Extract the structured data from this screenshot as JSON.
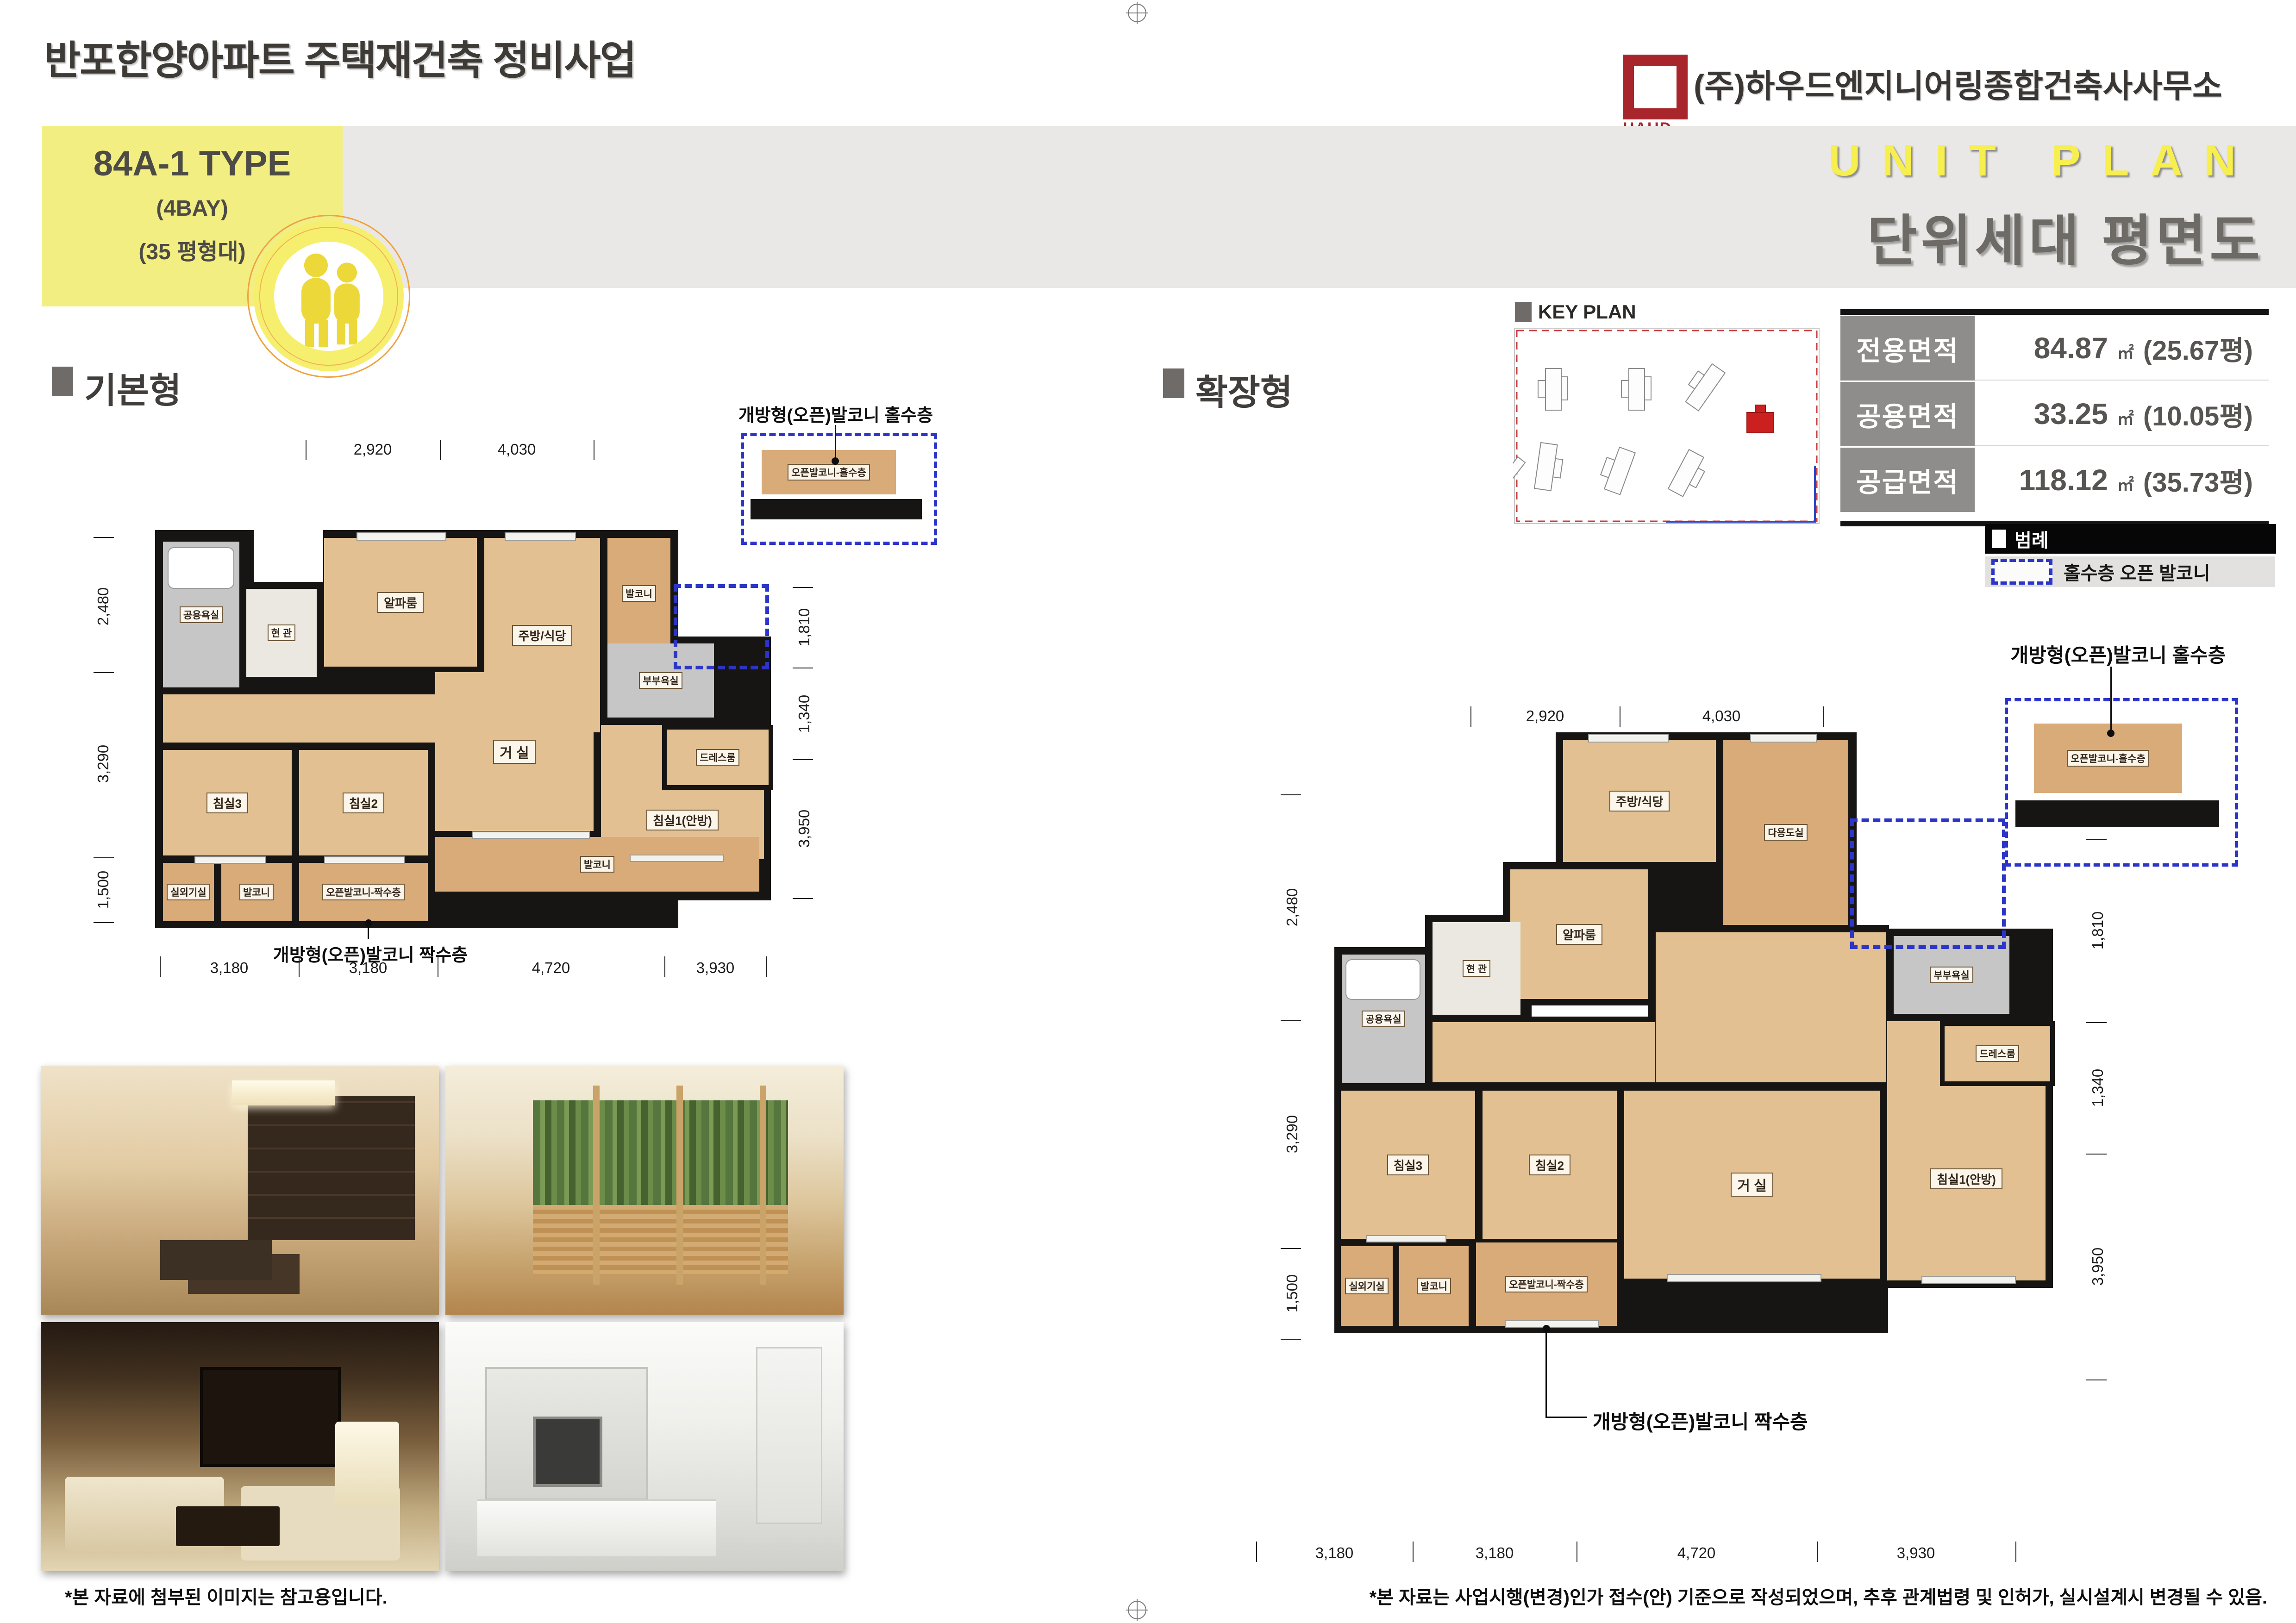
{
  "page": {
    "title": "반포한양아파트 주택재건축 정비사업",
    "company": "(주)하우드엔지니어링종합건축사사무소",
    "logo_text": "HAUD",
    "unit_plan_en": "UNIT PLAN",
    "unit_plan_ko": "단위세대 평면도",
    "footnote_left": "*본 자료에 첨부된 이미지는 참고용입니다.",
    "footnote_right": "*본 자료는 사업시행(변경)인가 접수(안) 기준으로 작성되었으며, 추후 관계법령 및 인허가, 실시설계시 변경될 수 있음."
  },
  "type_box": {
    "name": "84A-1 TYPE",
    "bay": "(4BAY)",
    "size": "(35 평형대)"
  },
  "key_plan": {
    "title": "KEY PLAN"
  },
  "sections": {
    "basic": "기본형",
    "extended": "확장형"
  },
  "area_table": {
    "rows": [
      {
        "label": "전용면적",
        "value": "84.87",
        "unit": "㎡",
        "pyeong": "(25.67평)"
      },
      {
        "label": "공용면적",
        "value": "33.25",
        "unit": "㎡",
        "pyeong": "(10.05평)"
      },
      {
        "label": "공급면적",
        "value": "118.12",
        "unit": "㎡",
        "pyeong": "(35.73평)"
      }
    ]
  },
  "legend": {
    "title": "범례",
    "item": "홀수층 오픈 발코니"
  },
  "rooms": {
    "entrance": "현 관",
    "common_bath": "공용욕실",
    "alpha": "알파룸",
    "kitchen": "주방/식당",
    "balcony": "발코니",
    "master_bath": "부부욕실",
    "dressroom": "드레스룸",
    "bed1": "침실1(안방)",
    "living": "거 실",
    "bed2": "침실2",
    "bed3": "침실3",
    "ac": "실외기실",
    "open_even": "오픈발코니-짝수층",
    "open_odd": "오픈발코니-홀수층",
    "utility": "다용도실"
  },
  "dims": {
    "top": [
      "2,920",
      "4,030"
    ],
    "left": [
      "2,480",
      "3,290",
      "1,500"
    ],
    "right": [
      "1,810",
      "1,340",
      "3,950"
    ],
    "bottom": [
      "3,180",
      "3,180",
      "4,720",
      "3,930"
    ]
  },
  "callouts": {
    "odd": "개방형(오픈)발코니 홀수층",
    "even": "개방형(오픈)발코니 짝수층"
  }
}
